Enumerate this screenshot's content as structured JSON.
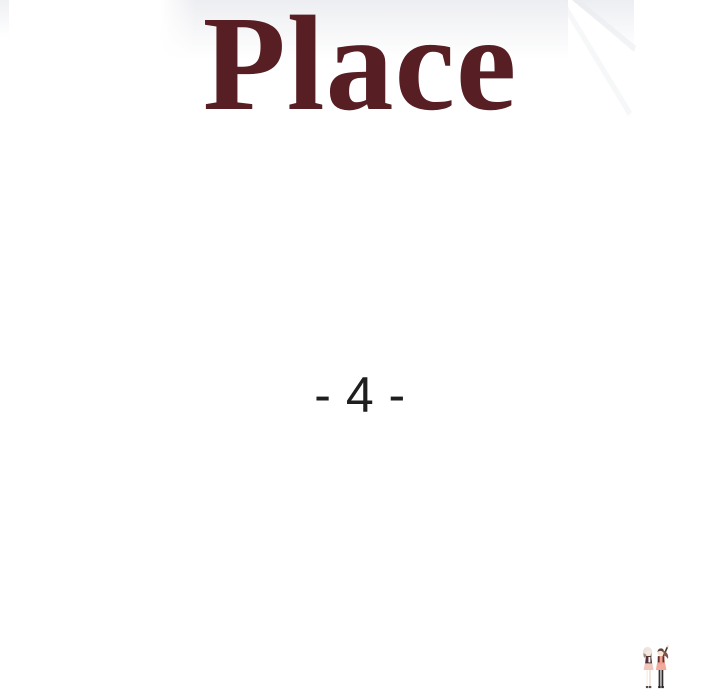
{
  "page": {
    "background_color": "#ffffff",
    "title": {
      "text": "Place",
      "color": "#571e23"
    },
    "episode": {
      "text": "- 4 -",
      "color": "#1e1e1e"
    },
    "decor": {
      "wash_color": "#ebecf0",
      "corner_shape": "faded-diagonal-corner",
      "illustration": "two-chibi-girls-standing",
      "illustration_colors": {
        "skin": "#f6e3d4",
        "left_hair": "#e9e2de",
        "right_hair": "#5f4238",
        "dress_pink": "#ee9f90",
        "dark_outfit": "#53333a",
        "stocking_black": "#342d30"
      }
    }
  }
}
